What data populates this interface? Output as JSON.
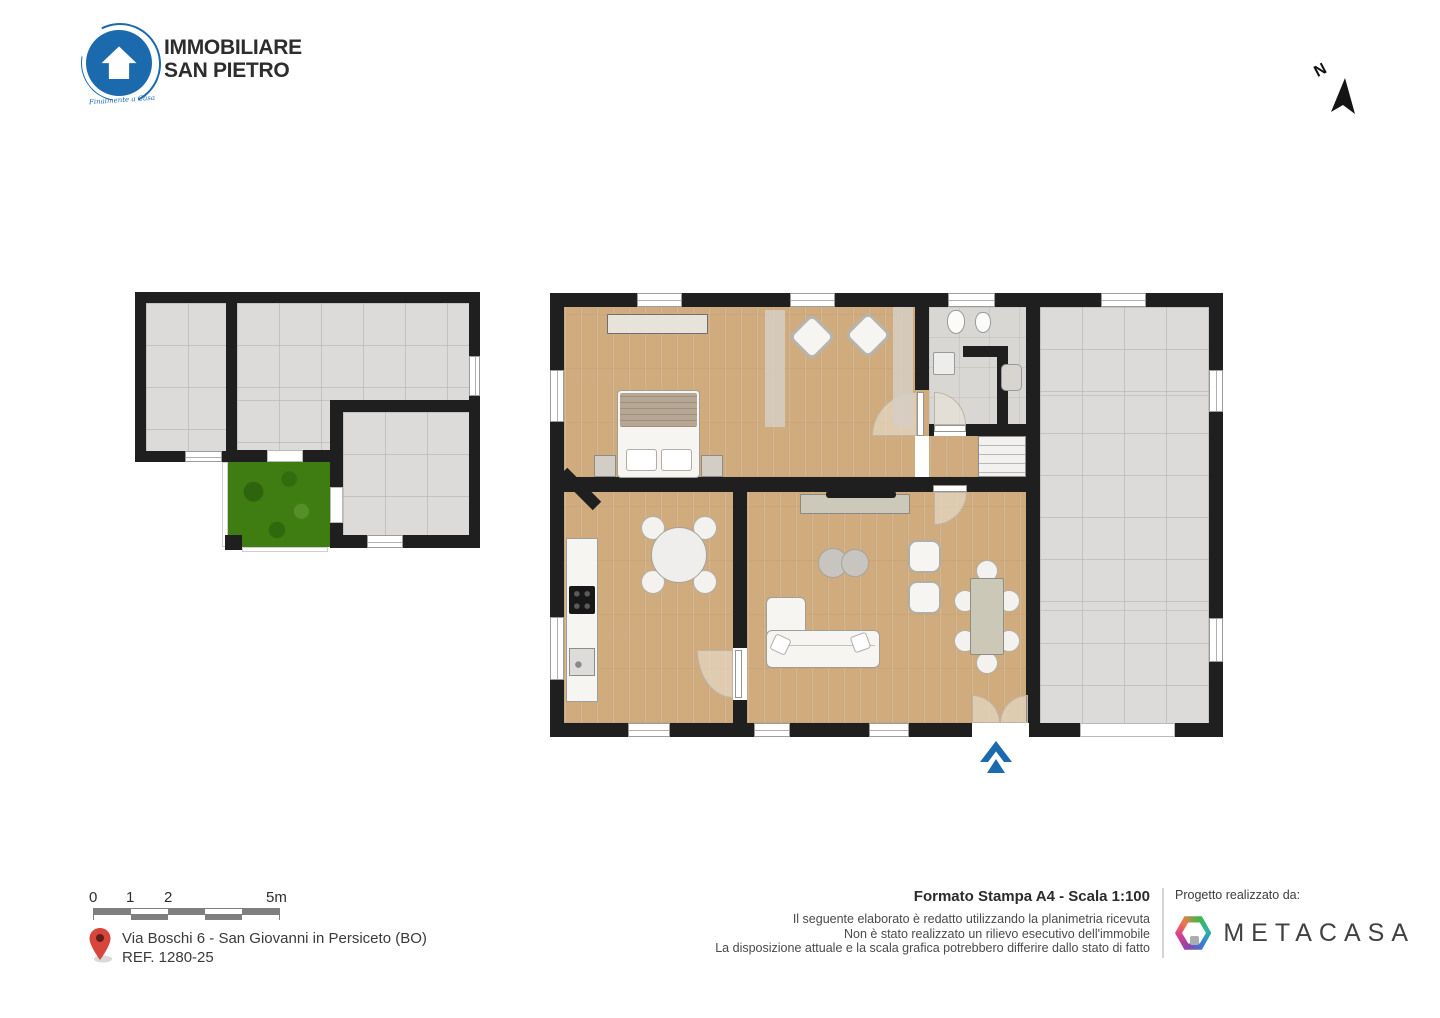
{
  "header": {
    "logo_line1": "IMMOBILIARE",
    "logo_line2": "SAN PIETRO",
    "logo_tagline": "Finalmente a Casa",
    "north_label": "N"
  },
  "footer": {
    "scalebar_labels": [
      "0",
      "1",
      "2",
      "5m"
    ],
    "address_line1": "Via Boschi 6 - San Giovanni in Persiceto (BO)",
    "address_line2": "REF. 1280-25",
    "print_title": "Formato Stampa A4 - Scala 1:100",
    "disclaimer": [
      "Il seguente elaborato è redatto utilizzando la planimetria ricevuta",
      "Non è stato realizzato un rilievo esecutivo dell'immobile",
      "La disposizione attuale e la scala grafica potrebbero differire dallo stato di fatto"
    ],
    "credit_label": "Progetto realizzato da:",
    "credit_brand": "METACASA"
  },
  "colors": {
    "brand_blue": "#1b6aad",
    "wall": "#1f1f1f",
    "wood": "#cfab7d",
    "tile": "#dcdbd9",
    "grass": "#3f7d12",
    "pin_red": "#d8453c",
    "metacasa_green": "#45b649",
    "metacasa_blue": "#3a7bd5",
    "metacasa_magenta": "#d6408f"
  }
}
